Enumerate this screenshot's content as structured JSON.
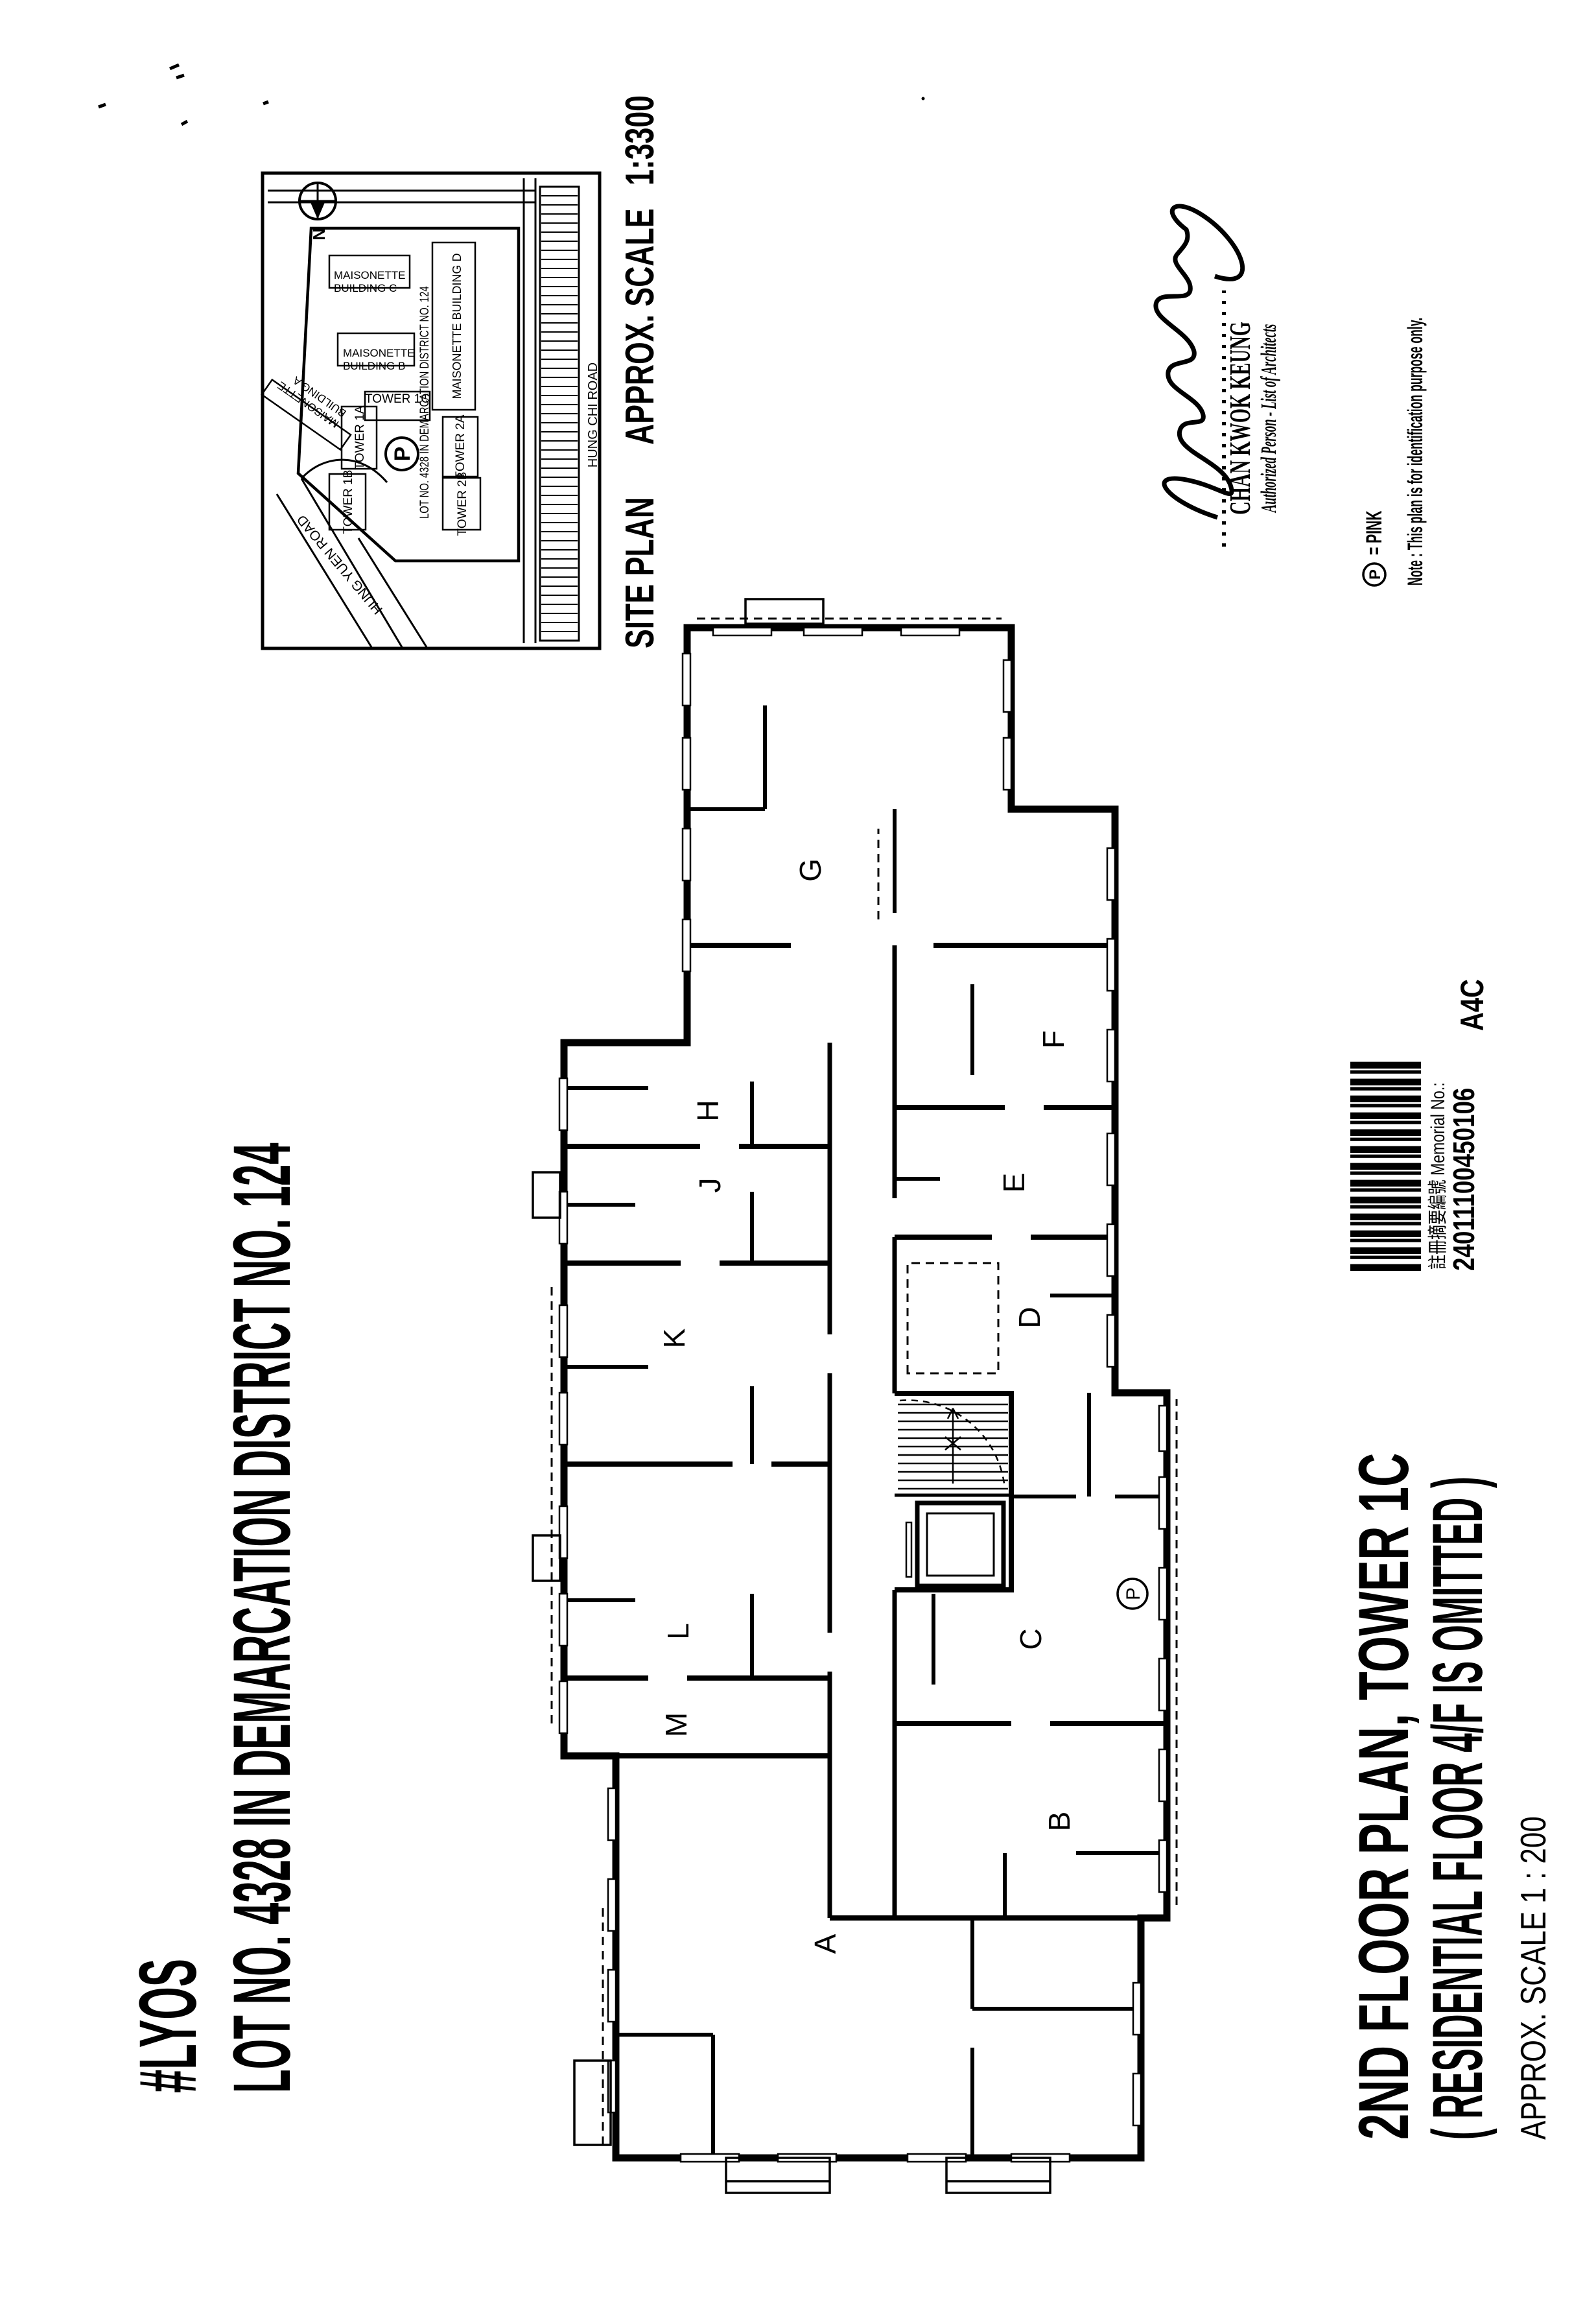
{
  "page": {
    "title_line1": "#LYOS",
    "title_line2": "LOT NO. 4328 IN DEMARCATION DISTRICT NO. 124"
  },
  "site_plan": {
    "caption_1": "SITE PLAN",
    "caption_2": "APPROX. SCALE",
    "caption_3": "1:3300",
    "north_label": "N",
    "road_top": "HUNG YUEN ROAD",
    "road_bottom": "HUNG CHI ROAD",
    "lot_text": "LOT NO. 4328 IN DEMARCATION DISTRICT NO. 124",
    "parking_label": "P",
    "buildings": {
      "a1": "MAISONETTE",
      "a2": "BUILDING A",
      "b1": "MAISONETTE",
      "b2": "BUILDING B",
      "c1": "MAISONETTE",
      "c2": "BUILDING C",
      "d": "MAISONETTE BUILDING D",
      "t1a": "TOWER 1A",
      "t1b": "TOWER 1B",
      "t1c": "TOWER 1C",
      "t2a": "TOWER 2A",
      "t2b": "TOWER 2B"
    }
  },
  "floor_plan": {
    "units": [
      "A",
      "B",
      "C",
      "D",
      "E",
      "F",
      "G",
      "H",
      "J",
      "K",
      "L",
      "M"
    ],
    "parking_label": "P"
  },
  "signature": {
    "name": "CHAN KWOK KEUNG",
    "role": "Authorized Person - List of Architects"
  },
  "legend": {
    "p_symbol": "P",
    "p_equals": "=  PINK",
    "note": "Note : This plan is for identification purpose only."
  },
  "memorial": {
    "label": "註冊摘要編號 Memorial No.:",
    "number": "24011100450106",
    "sheet_code": "A4C"
  },
  "footer": {
    "line1": "2ND FLOOR PLAN, TOWER 1C",
    "line2": "( RESIDENTIAL FLOOR 4/F IS OMITTED )",
    "line3": "APPROX. SCALE  1 : 200"
  }
}
